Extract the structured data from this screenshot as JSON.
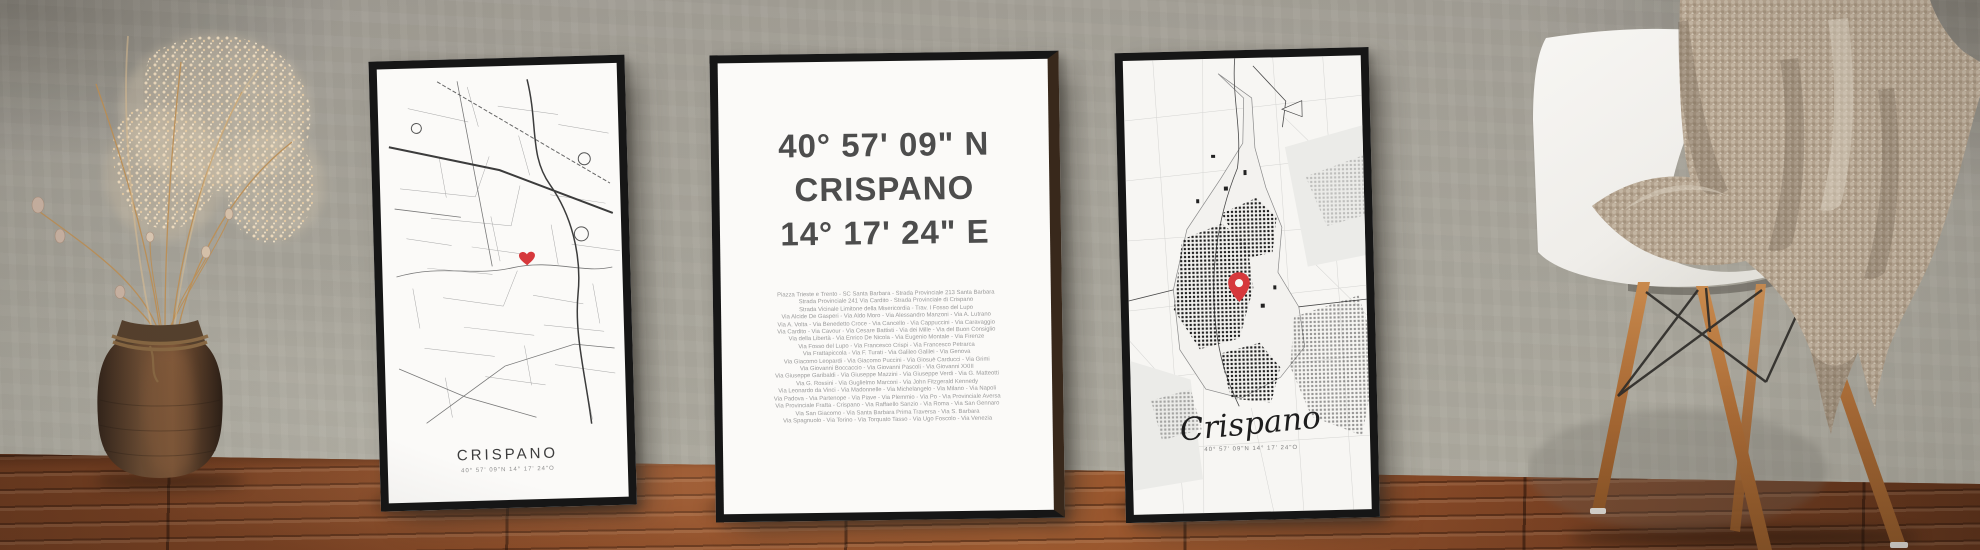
{
  "scene": {
    "description": "Three framed Crispano map posters leaning against a concrete wall on a wooden floor, with a dried-flower vase on the left and a white shell chair with a knit blanket on the right"
  },
  "posters": {
    "left": {
      "title": "CRISPANO",
      "coordinates": "40° 57' 09\"N 14° 17' 24\"O"
    },
    "middle": {
      "latitude": "40° 57' 09\" N",
      "city": "CRISPANO",
      "longitude": "14° 17' 24\" E",
      "streets": [
        "Piazza Trieste e Trento - SC Santa Barbara - Strada Provinciale 213 Santa Barbara",
        "Strada Provinciale 241 Via Cardito - Strada Provinciale di Crispano",
        "Strada Vicinale Limitone della Misericordia - Trav. I Fosso del Lupo",
        "Via Alcide De Gasperi - Via Aldo Moro - Via Alessandro Manzoni - Via A. Lutrano",
        "Via A. Volta - Via Benedetto Croce - Via Cancello - Via Cappuccini - Via Caravaggio",
        "Via Cardito - Via Cavour - Via Cesare Battisti - Via dei Mille - Via del Buon Consiglio",
        "Via della Libertà - Via Enrico De Nicola - Via Eugenio Montale - Via Firenze",
        "Via Fosso del Lupo - Via Francesco Crispi - Via Francesco Petrarca",
        "Via Frattapiccola - Via F. Turati - Via Galileo Galilei - Via Genova",
        "Via Giacomo Leopardi - Via Giacomo Puccini - Via Giosuè Carducci - Via Grimi",
        "Via Giovanni Boccaccio - Via Giovanni Pascoli - Via Giovanni XXIII",
        "Via Giuseppe Garibaldi - Via Giuseppe Mazzini - Via Giuseppe Verdi - Via G. Matteotti",
        "Via G. Rossini - Via Guglielmo Marconi - Via John Fitzgerald Kennedy",
        "Via Leonardo da Vinci - Via Madonnelle - Via Michelangelo - Via Milano - Via Napoli",
        "Via Padova - Via Partenope - Via Piave - Via Plemmio - Via Po - Via Provinciale Aversa",
        "Via Provinciale Fratta - Crispano - Via Raffaello Sanzio - Via Roma - Via San Gennaro",
        "Via San Giacomo - Via Santa Barbara Prima Traversa - Via S. Barbara",
        "Via Spagnuolo - Via Torino - Via Torquato Tasso - Via Ugo Foscolo - Via Venezia"
      ]
    },
    "right": {
      "title": "Crispano",
      "coordinates": "40° 57' 09\"N 14° 17' 24\"O"
    }
  },
  "icons": {
    "heart": "heart-icon (red love-heart marking the location on the left map)",
    "map_pin": "map-pin-icon (red location pin on the right map)"
  },
  "colors": {
    "wall": "#a8a59b",
    "floor_wood": "#8a4a26",
    "frame": "#161616",
    "paper": "#fbfaf8",
    "big_text": "#4d4d4d",
    "small_text": "#9b9b9b",
    "map_line": "#8a8a8a",
    "heart_red": "#d6383c",
    "pin_red": "#d6383c",
    "blanket": "#b3a28e",
    "chair_shell": "#f4f3f0",
    "chair_legs": "#b5763f",
    "vase": "#5d4430",
    "dried_flowers": "#e3cdb2"
  }
}
